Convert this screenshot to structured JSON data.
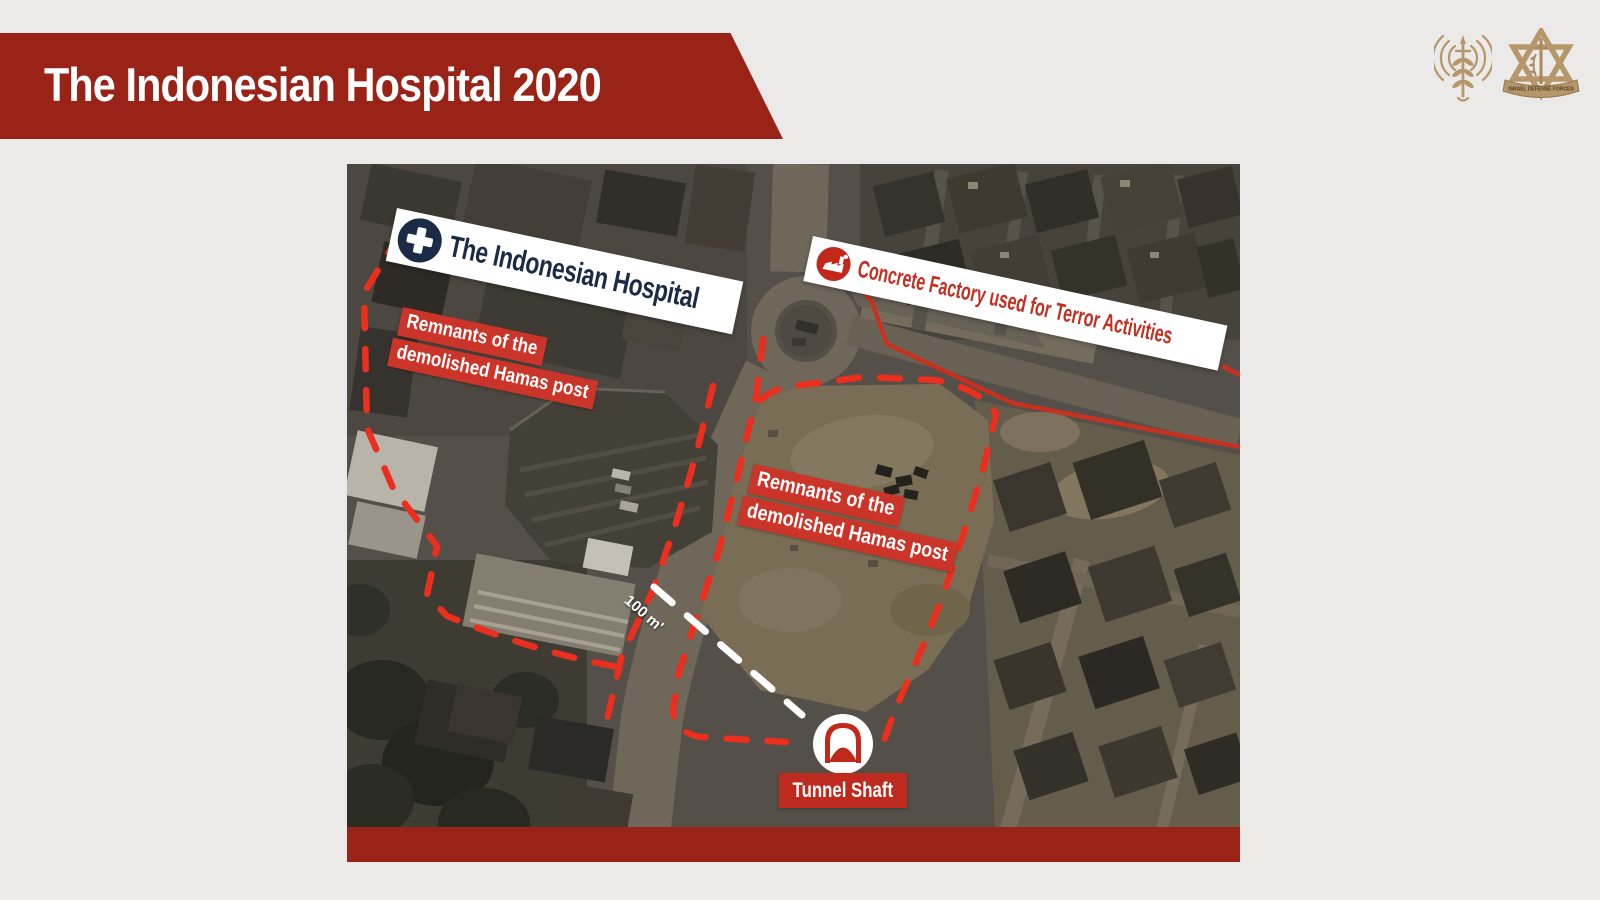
{
  "header": {
    "title": "The Indonesian Hospital 2020"
  },
  "logos": {
    "spokesperson_icon": "idf-spokesperson-unit-emblem",
    "idf_icon": "idf-emblem",
    "idf_ribbon_text": "ISRAEL DEFENSE FORCES"
  },
  "map": {
    "hospital": {
      "label": "The Indonesian Hospital",
      "icon": "medical-cross-icon"
    },
    "factory": {
      "label": "Concrete Factory used for Terror Activities",
      "icon": "factory-icon"
    },
    "remnants_left": {
      "line1": "Remnants of the",
      "line2": "demolished Hamas post"
    },
    "remnants_center": {
      "line1": "Remnants of the",
      "line2": "demolished Hamas post"
    },
    "distance": {
      "label": "100 m'"
    },
    "tunnel": {
      "label": "Tunnel Shaft",
      "icon": "tunnel-icon"
    }
  },
  "colors": {
    "header_red": "#9A2318",
    "label_red": "#CB3428",
    "dash_red": "#EA2F1E",
    "solid_line_red": "#C8311F",
    "navy": "#1B2A47",
    "gold": "#B5976B",
    "slide_background": "#ECEAE8"
  }
}
